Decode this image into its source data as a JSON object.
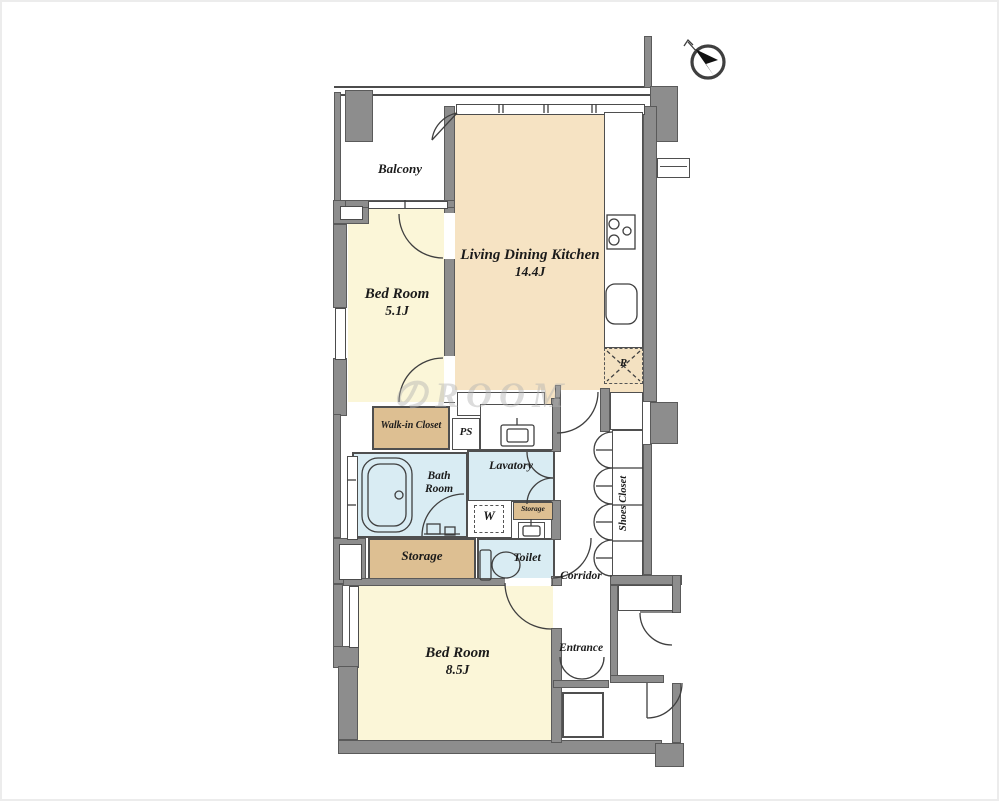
{
  "watermark": "のROOM",
  "compass": {
    "icon": "north-arrow"
  },
  "colors": {
    "wall": "#8d8d8d",
    "line": "#3f3f3f",
    "ldk": "#f6e3c3",
    "bedroom": "#fbf6d8",
    "closet": "#ddbf92",
    "wet": "#d9ecf3",
    "text": "#1b1b1b"
  },
  "rooms": {
    "balcony": "Balcony",
    "ldk": {
      "name": "Living Dining Kitchen",
      "size": "14.4J"
    },
    "bedroom_small": {
      "name": "Bed Room",
      "size": "5.1J"
    },
    "bedroom_large": {
      "name": "Bed Room",
      "size": "8.5J"
    },
    "walk_in_closet": "Walk-in Closet",
    "ps": "PS",
    "bath": {
      "line1": "Bath",
      "line2": "Room"
    },
    "lavatory": "Lavatory",
    "washer": "W",
    "storage_small": "Storage",
    "storage": "Storage",
    "toilet": "Toilet",
    "corridor": "Corridor",
    "shoes_closet": "Shoes Closet",
    "entrance": "Entrance",
    "refrigerator": "R"
  }
}
